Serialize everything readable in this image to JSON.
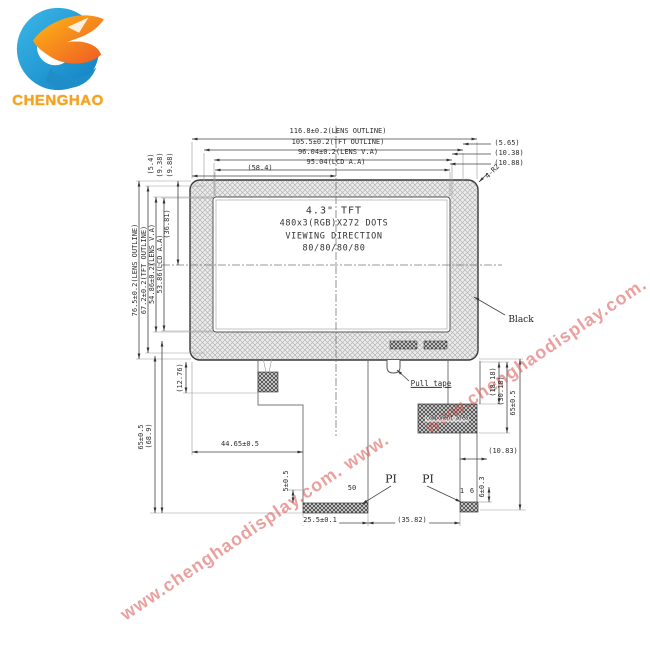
{
  "brand": {
    "name": "CHENGHAO"
  },
  "watermark": {
    "text": "www.chenghaodisplay.com.",
    "text_long": "www.chenghaodisplay.com. www.",
    "color": "#d9534f"
  },
  "panel": {
    "size_label": "4.3\" TFT",
    "resolution": "480x3(RGB)X272 DOTS",
    "viewing": "VIEWING DIRECTION",
    "angles": "80/80/80/80",
    "bezel_label": "Black",
    "corner_radius": "4-R2"
  },
  "dims": {
    "lens_w": "116.8±0.2(LENS OUTLINE)",
    "tft_w": "105.5±0.2(TFT OUTLINE)",
    "lens_va_w": "96.04±0.2(LENS V.A)",
    "lcd_aa_w": "95.04(LCD A.A)",
    "center_w": "(58.4)",
    "lens_h": "76.5±0.2(LENS OUTLINE)",
    "tft_h": "67.2±0.2(TFT OUTLINE)",
    "lens_va_h": "54.86±0.2(LENS V.A)",
    "lcd_aa_h": "53.86(LCD A.A)",
    "center_h": "(36.81)",
    "left_offsets": [
      "(5.4)",
      "(9.38)",
      "(9.88)"
    ],
    "right_offsets": [
      "(5.65)",
      "(10.38)",
      "(10.88)"
    ],
    "fpc_len_left": "65±0.5",
    "fpc_len_left_ref": "(68.9)",
    "tape_offset": "(12.76)",
    "neck_offset": "44.65±0.5",
    "pi_offset_left": "5±0.5",
    "comp_top": "(18.18)",
    "comp_bot": "(30.18)",
    "fpc_len_right": "65±0.5",
    "comp_offset_right": "(10.83)",
    "pi_offset_right": "6±0.3",
    "pi_width": "25.5±0.1",
    "pi_gap": "(35.82)"
  },
  "fpc": {
    "pull_tape": "Pull tape",
    "component_area": "component area",
    "pi": "PI",
    "pin_50": "50",
    "pin_1": "1",
    "pin_6": "6"
  }
}
